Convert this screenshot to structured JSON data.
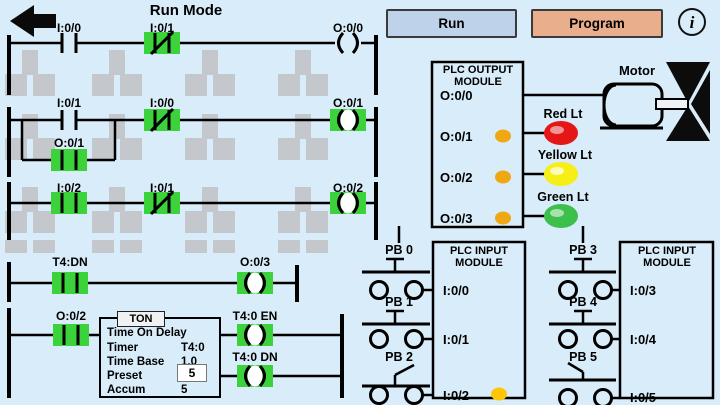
{
  "header": {
    "title": "Run Mode",
    "run_button": "Run",
    "program_button": "Program",
    "info_label": "i"
  },
  "ladder": {
    "rung1": {
      "c1": "I:0/0",
      "c2": "I:0/1",
      "coil": "O:0/0"
    },
    "rung2": {
      "c1": "I:0/1",
      "c2": "I:0/0",
      "branch": "O:0/1",
      "coil": "O:0/1"
    },
    "rung3": {
      "c1": "I:0/2",
      "c2": "I:0/1",
      "coil": "O:0/2"
    },
    "rung4": {
      "c1": "T4:DN",
      "coil": "O:0/3"
    },
    "rung5": {
      "c1": "O:0/2",
      "en_label": "T4:0 EN",
      "dn_label": "T4:0 DN"
    },
    "timer": {
      "title": "TON",
      "description": "Time On Delay",
      "timer_label": "Timer",
      "timer_value": "T4:0",
      "base_label": "Time Base",
      "base_value": "1.0",
      "preset_label": "Preset",
      "preset_value": "5",
      "accum_label": "Accum",
      "accum_value": "5"
    }
  },
  "output_module": {
    "title": "PLC OUTPUT MODULE",
    "ch0": "O:0/0",
    "ch1": "O:0/1",
    "ch2": "O:0/2",
    "ch3": "O:0/3",
    "indicators_lit": [
      "O:0/1",
      "O:0/2",
      "O:0/3"
    ]
  },
  "devices": {
    "motor": "Motor",
    "red": "Red Lt",
    "yellow": "Yellow Lt",
    "green": "Green Lt"
  },
  "input_module_1": {
    "title": "PLC INPUT MODULE",
    "ch0": "I:0/0",
    "ch1": "I:0/1",
    "ch2": "I:0/2",
    "indicators_lit": [
      "I:0/2"
    ]
  },
  "input_module_2": {
    "title": "PLC INPUT MODULE",
    "ch0": "I:0/3",
    "ch1": "I:0/4",
    "ch2": "I:0/5",
    "indicators_lit": []
  },
  "push_buttons": {
    "pb0": "PB 0",
    "pb1": "PB 1",
    "pb2": "PB 2",
    "pb3": "PB 3",
    "pb4": "PB 4",
    "pb5": "PB 5"
  },
  "colors": {
    "background": "#d9ecf9",
    "highlight_green": "#3cd23c",
    "output_indicator": "#f0a714",
    "input_indicator": "#ffc608",
    "red_light": "#e41616",
    "yellow_light": "#f6ee14",
    "green_light": "#3cbf4b",
    "run_button_bg": "#bed3e9",
    "program_button_bg": "#e9ae8b",
    "watermark_gray": "#c4c8cc",
    "coil_center_white": "#ffffff"
  }
}
